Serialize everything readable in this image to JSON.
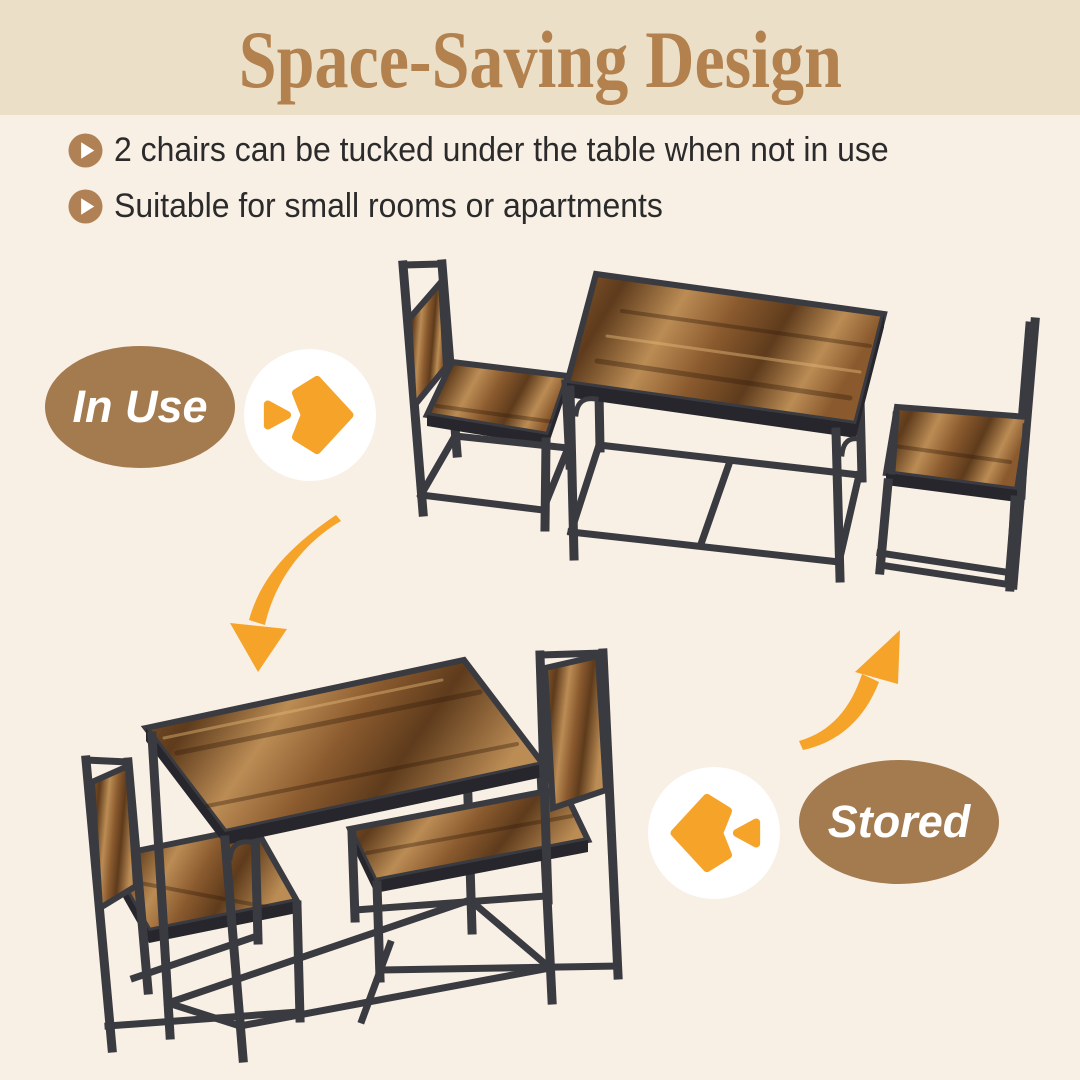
{
  "header": {
    "title": "Space-Saving Design"
  },
  "features": [
    {
      "icon": "play-circle-icon",
      "text": "2 chairs can be tucked under the table when not in use"
    },
    {
      "icon": "play-circle-icon",
      "text": "Suitable for small rooms or apartments"
    }
  ],
  "states": {
    "in_use": {
      "label": "In Use"
    },
    "stored": {
      "label": "Stored"
    }
  },
  "icons": {
    "bullet": "play-circle-icon",
    "transition_to_stored": "double-arrow-right-icon",
    "transition_to_in_use": "double-arrow-left-icon",
    "flow_down": "curved-arrow-down-icon",
    "flow_up": "curved-arrow-up-icon"
  },
  "colors": {
    "bg": "#f8efe5",
    "band_bg": "#ebdfc8",
    "title_brown": "#b2814e",
    "text_dark": "#2b2b2b",
    "bullet_brown": "#b08155",
    "pill_brown": "#a47a4f",
    "pill_text": "#ffffff",
    "accent_orange": "#f6a32a",
    "frame_dark": "#3a3a41",
    "frame_deep": "#26262c",
    "wood_light": "#bb8c54",
    "wood_mid": "#8a5a2e",
    "wood_dark": "#5e3b1c",
    "white": "#ffffff"
  }
}
